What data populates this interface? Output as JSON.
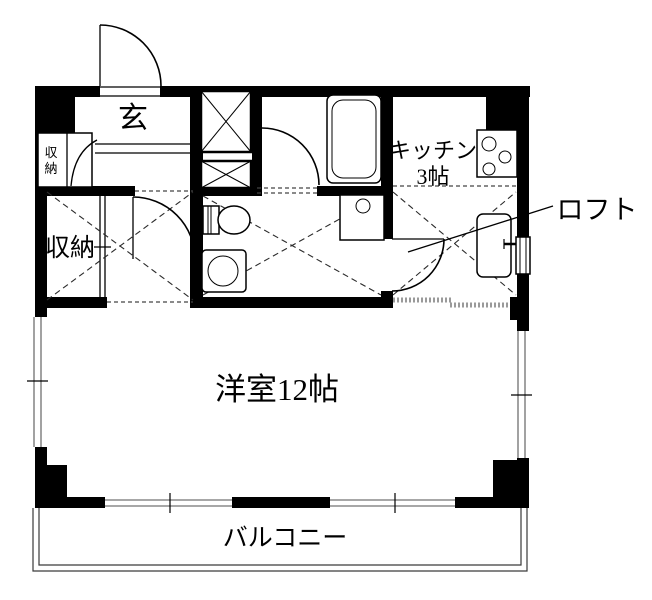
{
  "plan": {
    "type": "apartment-floor-plan",
    "colors": {
      "wall": "#000000",
      "background": "#ffffff",
      "window_line": "#8a8a8a",
      "loft_dash": "#2a2a2a",
      "accordion_dot": "#9a9a9a"
    },
    "labels": {
      "entrance": "玄",
      "entry_closet": {
        "full": "収納",
        "chars": [
          "収",
          "納"
        ]
      },
      "storage_room": "収納",
      "kitchen_line1": "キッチン",
      "kitchen_line2": "3帖",
      "loft": "ロフト",
      "main_room": "洋室12帖",
      "balcony": "バルコニー"
    }
  }
}
